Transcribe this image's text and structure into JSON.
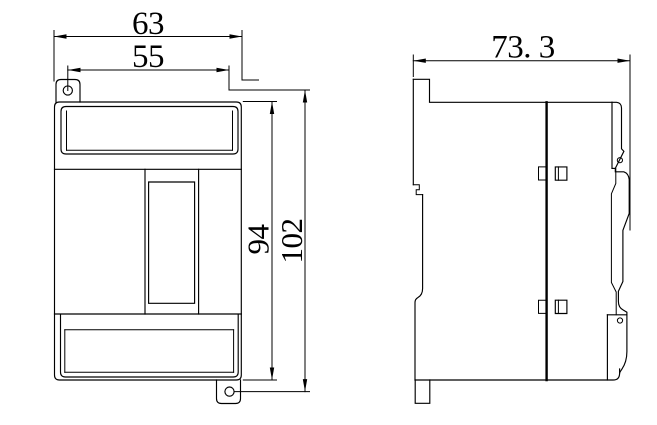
{
  "page": {
    "background": "#ffffff",
    "line_color": "#000000"
  },
  "views": {
    "front": {
      "name": "front-view"
    },
    "side": {
      "name": "side-view"
    }
  },
  "dimensions": {
    "front_width_overall": {
      "label": "63"
    },
    "front_width_upper": {
      "label": "55"
    },
    "front_height_body": {
      "label": "94"
    },
    "front_height_overall": {
      "label": "102"
    },
    "side_depth": {
      "label": "73. 3"
    }
  }
}
